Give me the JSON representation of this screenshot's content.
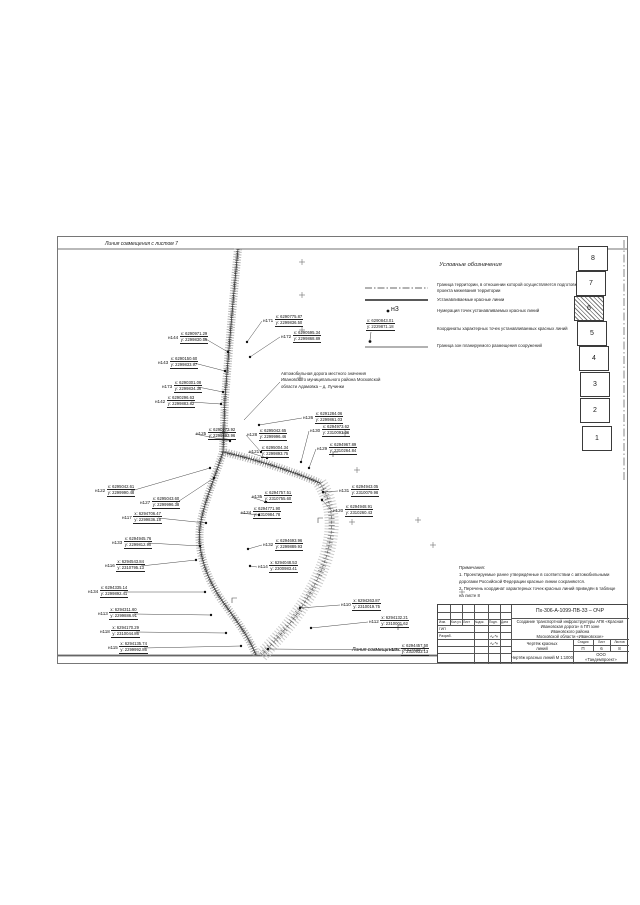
{
  "match_lines": {
    "top": "Линия совмещения с листом 7",
    "bottom": "Линия совмещения с листом 5"
  },
  "legend": {
    "title": "Условные обозначения",
    "items": [
      {
        "swatch": "dash-dot-line",
        "text": "Граница территории, в отношении которой осуществляется подготовка проекта межевания территории"
      },
      {
        "swatch": "solid-thick-line",
        "text": "Устанавливаемые красные линии"
      },
      {
        "swatch": "numbered-point",
        "sample_id": "н3",
        "text": "Нумерация точек устанавливаемых красных линий"
      },
      {
        "swatch": "coordinates-sample",
        "sample_x": "x: 6290843.01",
        "sample_y": "y: 2229871.18",
        "text": "Координаты характерных точек устанавливаемых красных линий"
      },
      {
        "swatch": "solid-thin-line",
        "text": "Граница зон планируемого размещения сооружений"
      }
    ]
  },
  "annotation": {
    "lines": [
      "Автомобильная дорога местного значения",
      "Ивановского муниципального района Московской",
      "области Адамовка – д. Лучинки"
    ]
  },
  "notes": {
    "title": "Примечания:",
    "items": [
      "1. Проектируемые ранее утверждённые в соответствии с автомобильными дорогами Российской Федерации красные линии сохраняются.",
      "2. Перечень координат характерных точек красных линий приведён в таблице на листе 8"
    ]
  },
  "sheet_index": {
    "sheets": [
      {
        "num": "8",
        "current": false
      },
      {
        "num": "7",
        "current": false
      },
      {
        "num": "6",
        "current": true
      },
      {
        "num": "5",
        "current": false
      },
      {
        "num": "4",
        "current": false
      },
      {
        "num": "3",
        "current": false
      },
      {
        "num": "2",
        "current": false
      },
      {
        "num": "1",
        "current": false
      }
    ]
  },
  "map": {
    "points": [
      {
        "id": "н171",
        "x": "x: 6290775.87",
        "y": "y: 2299836.50",
        "lx": 263,
        "ly": 315,
        "px": 247,
        "py": 342
      },
      {
        "id": "н172",
        "x": "x: 6290595.34",
        "y": "y: 2299868.89",
        "lx": 281,
        "ly": 331,
        "px": 250,
        "py": 357
      },
      {
        "id": "н144",
        "x": "x: 6290971.29",
        "y": "y: 2299830.56",
        "lx": 168,
        "ly": 332,
        "px": 228,
        "py": 352
      },
      {
        "id": "н143",
        "x": "x: 6290150.60",
        "y": "y: 2299833.97",
        "lx": 158,
        "ly": 357,
        "px": 225,
        "py": 371
      },
      {
        "id": "н173",
        "x": "x: 6290301.08",
        "y": "y: 2299834.36",
        "lx": 162,
        "ly": 381,
        "px": 223,
        "py": 392
      },
      {
        "id": "н142",
        "x": "x: 6290296.63",
        "y": "y: 2299883.82",
        "lx": 155,
        "ly": 396,
        "px": 221,
        "py": 404
      },
      {
        "id": "н126",
        "x": "x: 6291284.06",
        "y": "y: 2299861.03",
        "lx": 303,
        "ly": 412,
        "px": 259,
        "py": 425
      },
      {
        "id": "н125",
        "x": "x: 6290273.92",
        "y": "y: 2299893.96",
        "lx": 196,
        "ly": 428,
        "px": 230,
        "py": 441
      },
      {
        "id": "н128",
        "x": "x: 6295042.65",
        "y": "y: 2299996.46",
        "lx": 247,
        "ly": 429,
        "px": 261,
        "py": 452
      },
      {
        "id": "н121",
        "x": "x: 6295004.34",
        "y": "y: 2299893.75",
        "lx": 249,
        "ly": 446,
        "px": 267,
        "py": 458
      },
      {
        "id": "н130",
        "x": "x: 6294973.62",
        "y": "y: 2310093.06",
        "lx": 310,
        "ly": 425,
        "px": 301,
        "py": 462
      },
      {
        "id": "н129",
        "x": "x: 6294967.89",
        "y": "y: 2310264.84",
        "lx": 317,
        "ly": 443,
        "px": 309,
        "py": 468
      },
      {
        "id": "н122",
        "x": "x: 6295042.61",
        "y": "y: 2299990.48",
        "lx": 95,
        "ly": 485,
        "px": 210,
        "py": 468
      },
      {
        "id": "н127",
        "x": "x: 6295043.60",
        "y": "y: 2299996.38",
        "lx": 140,
        "ly": 497,
        "px": 214,
        "py": 478
      },
      {
        "id": "н135",
        "x": "x: 6294757.51",
        "y": "y: 2310755.60",
        "lx": 252,
        "ly": 491,
        "px": 266,
        "py": 502
      },
      {
        "id": "н124",
        "x": "x: 6294771.90",
        "y": "y: 2310984.78",
        "lx": 241,
        "ly": 507,
        "px": 259,
        "py": 515
      },
      {
        "id": "н131",
        "x": "x: 6294943.05",
        "y": "y: 2310079.98",
        "lx": 339,
        "ly": 485,
        "px": 323,
        "py": 492
      },
      {
        "id": "н120",
        "x": "x: 6294948.91",
        "y": "y: 2310260.43",
        "lx": 333,
        "ly": 505,
        "px": 322,
        "py": 500
      },
      {
        "id": "н117",
        "x": "x: 6294706.47",
        "y": "y: 2299836.18",
        "lx": 122,
        "ly": 512,
        "px": 206,
        "py": 523
      },
      {
        "id": "н133",
        "x": "x: 6294945.76",
        "y": "y: 2299812.90",
        "lx": 112,
        "ly": 537,
        "px": 200,
        "py": 546
      },
      {
        "id": "н116",
        "x": "x: 6294543.84",
        "y": "y: 2310795.13",
        "lx": 105,
        "ly": 560,
        "px": 196,
        "py": 560
      },
      {
        "id": "н132",
        "x": "x: 6294693.96",
        "y": "y: 2299889.93",
        "lx": 263,
        "ly": 539,
        "px": 248,
        "py": 549
      },
      {
        "id": "н114",
        "x": "x: 6294048.53",
        "y": "y: 2300983.41",
        "lx": 258,
        "ly": 561,
        "px": 250,
        "py": 566
      },
      {
        "id": "н110",
        "x": "x: 6294263.87",
        "y": "y: 2310019.75",
        "lx": 341,
        "ly": 599,
        "px": 300,
        "py": 608
      },
      {
        "id": "н134",
        "x": "x: 6294335.14",
        "y": "y: 2299892.41",
        "lx": 88,
        "ly": 586,
        "px": 205,
        "py": 592
      },
      {
        "id": "н113",
        "x": "x: 6294311.60",
        "y": "y: 2299886.91",
        "lx": 98,
        "ly": 608,
        "px": 211,
        "py": 615
      },
      {
        "id": "н118",
        "x": "x: 6294170.29",
        "y": "y: 2310044.86",
        "lx": 100,
        "ly": 626,
        "px": 226,
        "py": 633
      },
      {
        "id": "н115",
        "x": "x: 6294135.74",
        "y": "y: 2299992.86",
        "lx": 108,
        "ly": 642,
        "px": 241,
        "py": 646
      },
      {
        "id": "н112",
        "x": "x: 6294132.21",
        "y": "y: 2310001.62",
        "lx": 369,
        "ly": 616,
        "px": 311,
        "py": 628
      },
      {
        "id": "н109",
        "x": "x: 6294457.50",
        "y": "y: 2310933.13",
        "lx": 389,
        "ly": 644,
        "px": 268,
        "py": 649
      }
    ]
  },
  "title_block": {
    "doc_number": "Пх-306-А-1099-ПВ-33 – ОЧР",
    "project_lines": [
      "Создание транспортной инфраструктуры АПК «Красная Ивановская дорога» в ПП зоне",
      "Ивановского района",
      "Московской области «Ивановское»"
    ],
    "drawing_cell_lines": [
      "Чертёж красных",
      "линий"
    ],
    "scale_line": "Чертёж красных линий М 1:1000",
    "org_lines": [
      "ООО",
      "«Тандемпроект»"
    ],
    "stage_headers": [
      "Стадия",
      "Лист",
      "Листов"
    ],
    "stage": "П",
    "sheet": "6",
    "sheets_total": "8",
    "rev_headers": [
      "Изм.",
      "Кол.уч.",
      "Лист",
      "№док.",
      "Подп.",
      "Дата"
    ],
    "roles": [
      "ГИП",
      "Разраб."
    ]
  }
}
